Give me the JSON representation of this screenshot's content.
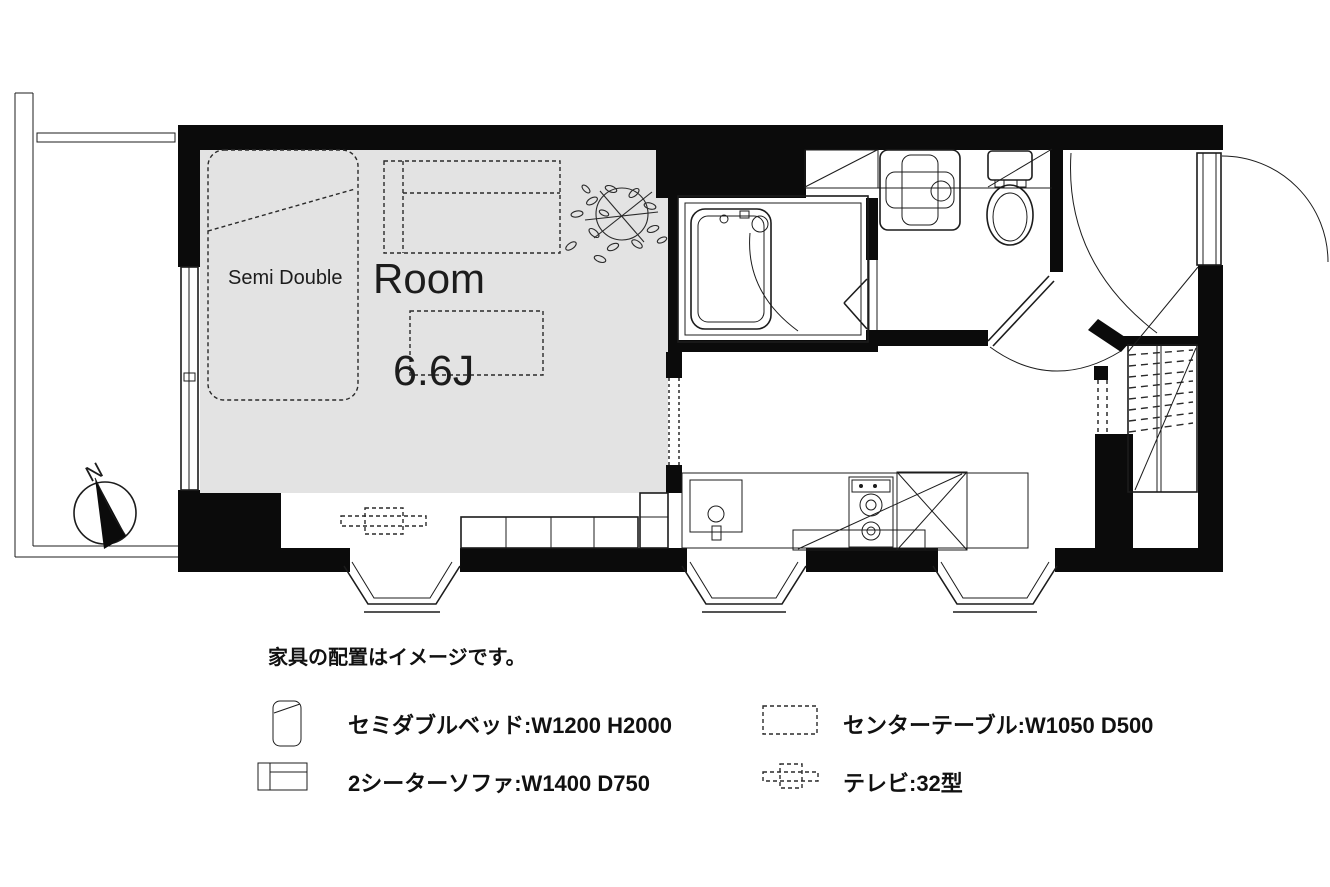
{
  "plan": {
    "room_label": "Room",
    "room_size": "6.6J",
    "bed_label": "Semi Double",
    "compass_label": "N"
  },
  "legend": {
    "note": "家具の配置はイメージです。",
    "items": [
      {
        "id": "semi-double-bed",
        "icon": "bed-icon",
        "label": "セミダブルベッド:W1200 H2000"
      },
      {
        "id": "center-table",
        "icon": "center-table-icon",
        "label": "センターテーブル:W1050 D500"
      },
      {
        "id": "two-seater-sofa",
        "icon": "sofa-icon",
        "label": "2シーターソファ:W1400 D750"
      },
      {
        "id": "tv",
        "icon": "tv-icon",
        "label": "テレビ:32型"
      }
    ]
  },
  "colors": {
    "wall": "#0b0b0b",
    "line": "#1c1c1c",
    "floor": "#e3e3e3",
    "background": "#ffffff"
  }
}
